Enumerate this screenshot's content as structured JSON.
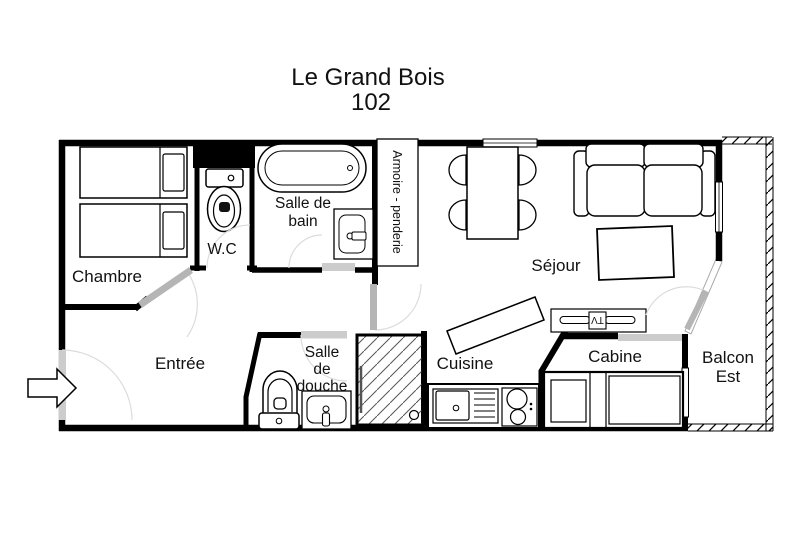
{
  "title": {
    "name": "Le Grand Bois",
    "number": "102"
  },
  "rooms": {
    "chambre": "Chambre",
    "wc": "W.C",
    "salle_de_bain_1": "Salle de",
    "salle_de_bain_2": "bain",
    "armoire": "Armoire - penderie",
    "sejour": "Séjour",
    "entree": "Entrée",
    "salle_de_douche_1": "Salle",
    "salle_de_douche_2": "de",
    "salle_de_douche_3": "douche",
    "cuisine": "Cuisine",
    "cabine": "Cabine",
    "balcon_1": "Balcon",
    "balcon_2": "Est"
  },
  "furniture": {
    "tv": "TV"
  },
  "colors": {
    "wall": "#000000",
    "door_leaf": "#b5b5b5",
    "door_sill": "#cccccc",
    "swing_arc": "#dcdcdc",
    "background": "#ffffff"
  }
}
